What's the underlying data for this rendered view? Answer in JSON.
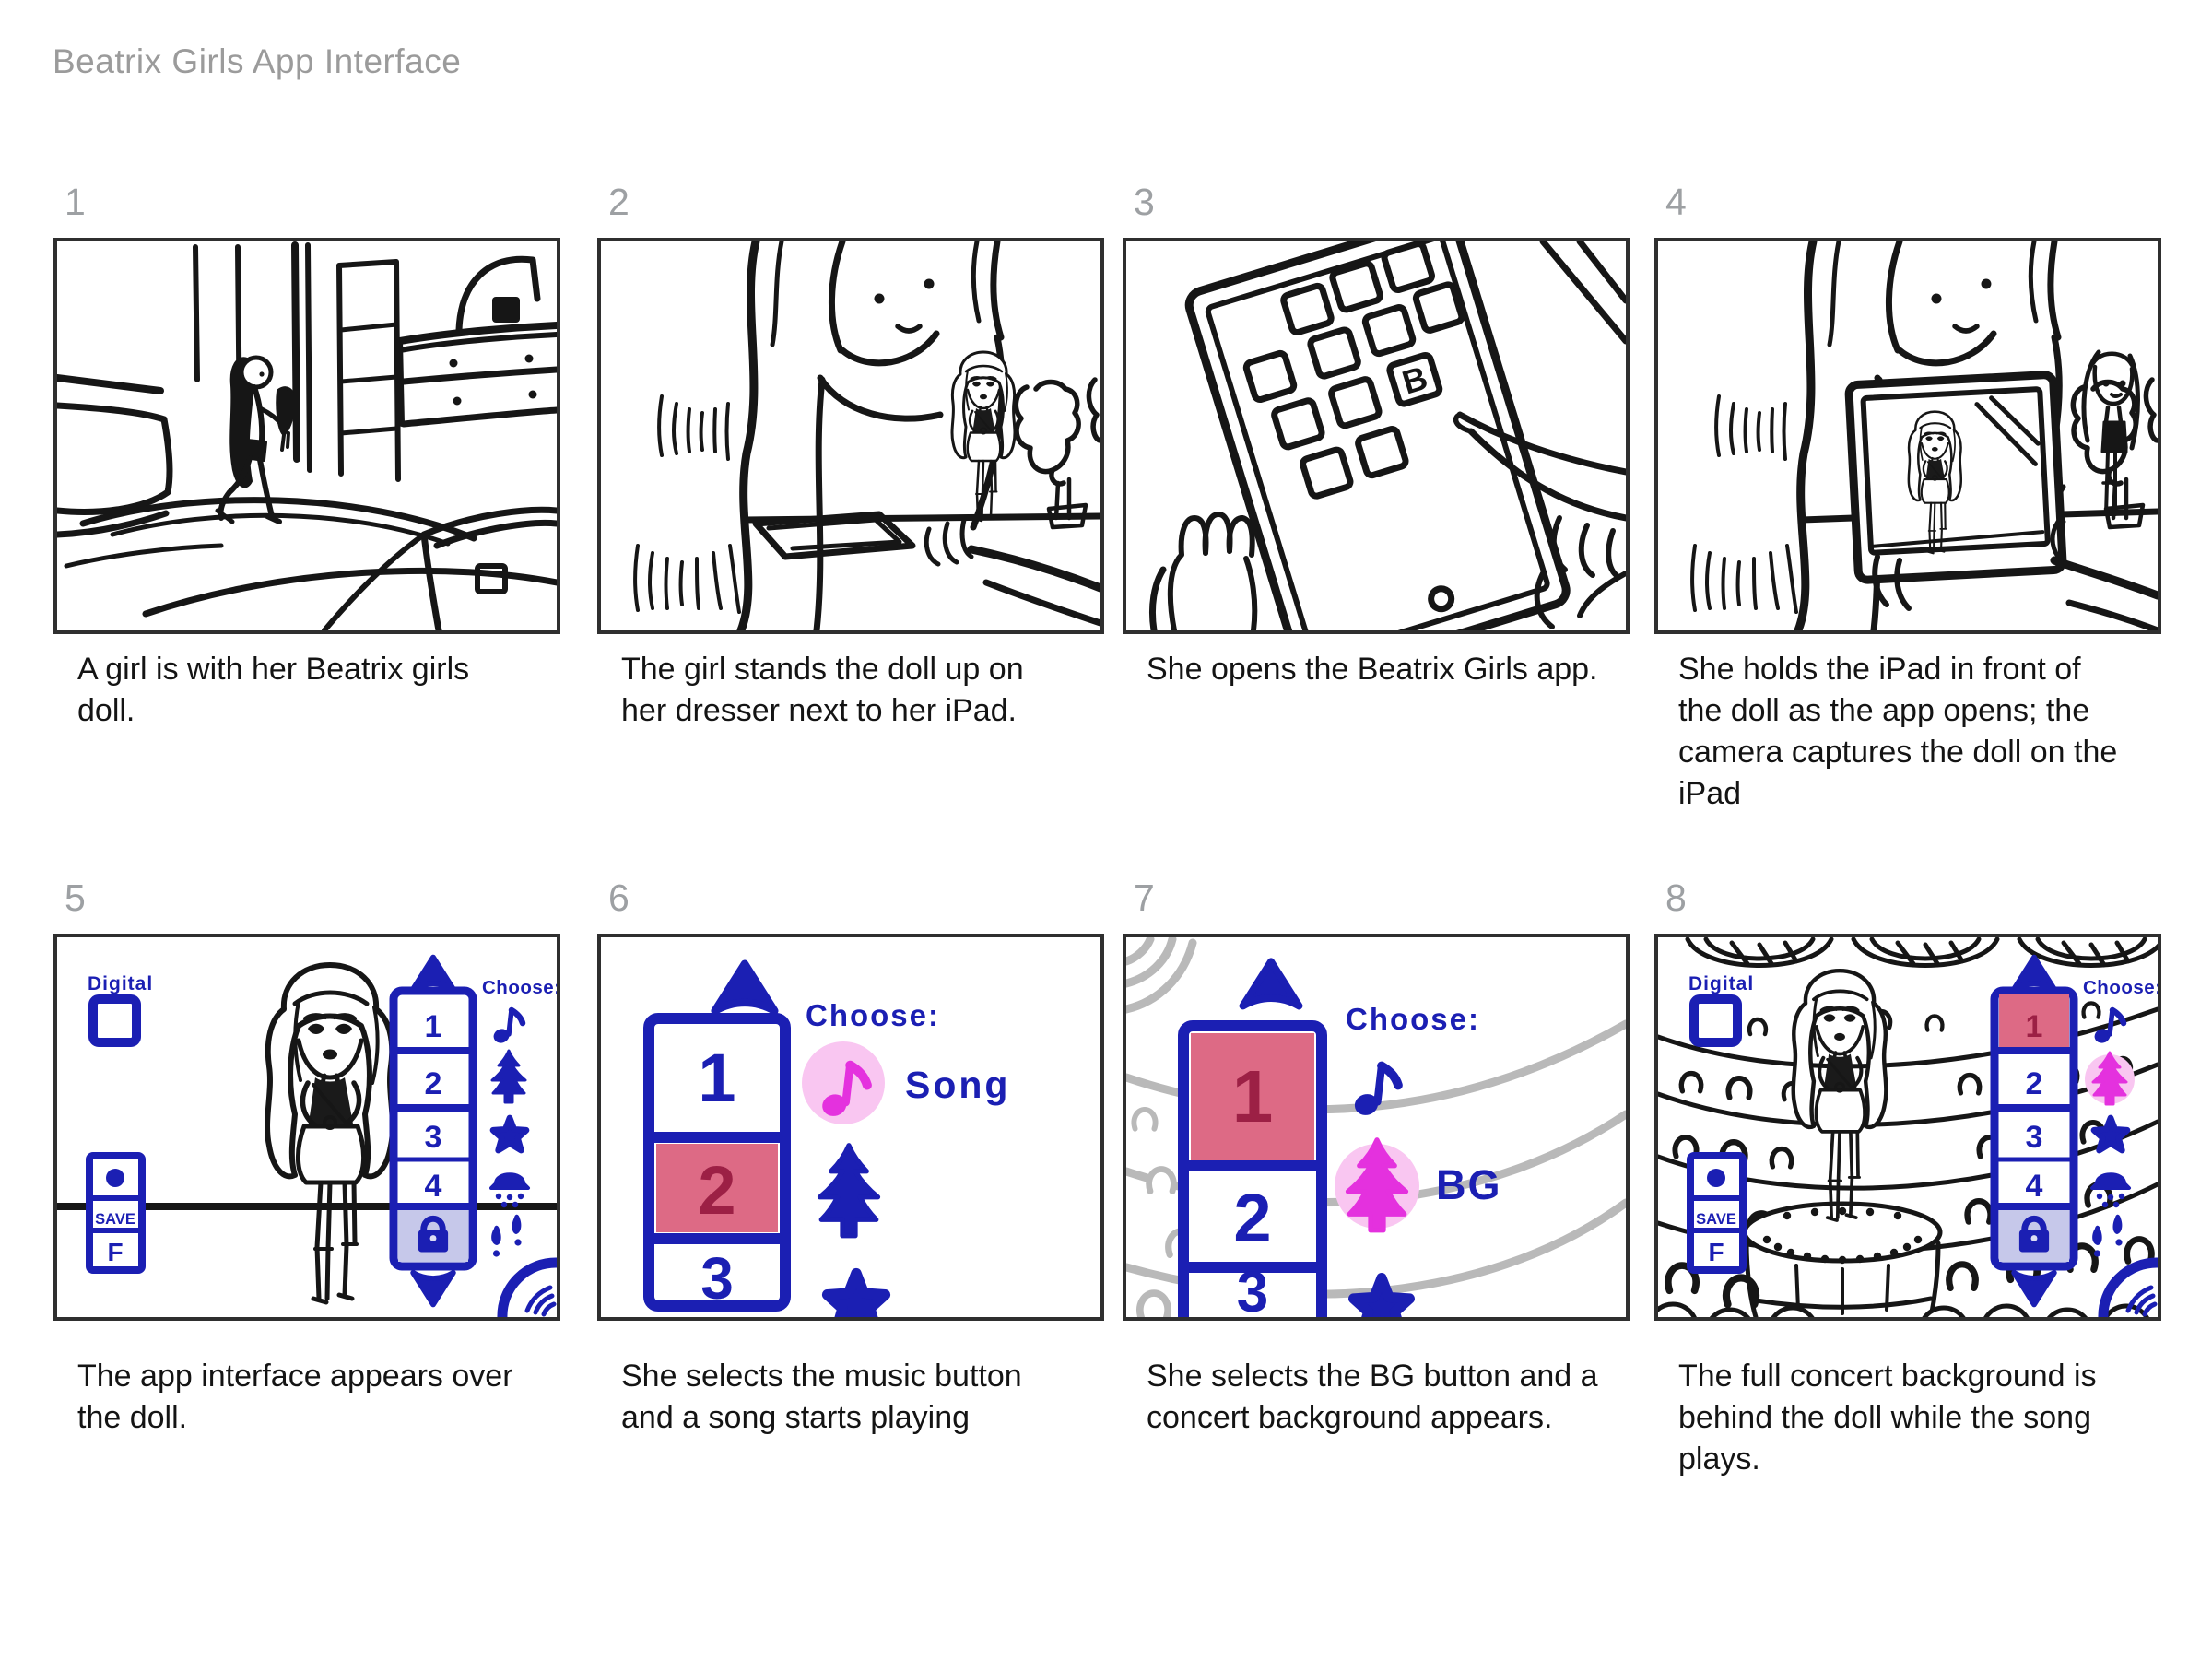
{
  "title": "Beatrix Girls App Interface",
  "panels": [
    {
      "number": "1",
      "caption": "A girl is with her Beatrix girls doll."
    },
    {
      "number": "2",
      "caption": "The girl stands the doll up on her dresser next to her iPad."
    },
    {
      "number": "3",
      "caption": "She opens the Beatrix Girls app."
    },
    {
      "number": "4",
      "caption": "She holds the iPad in front of the doll as the app opens; the camera captures the doll on the iPad"
    },
    {
      "number": "5",
      "caption": "The app interface appears over the doll."
    },
    {
      "number": "6",
      "caption": "She selects the music button and a song starts playing"
    },
    {
      "number": "7",
      "caption": "She selects the BG button and a concert background appears."
    },
    {
      "number": "8",
      "caption": "The full concert background is behind the doll while the song plays."
    }
  ],
  "app_ui": {
    "digital_label": "Digital",
    "save_label": "SAVE",
    "f_label": "F",
    "choose_label": "Choose:",
    "song_label": "Song",
    "bg_label": "BG",
    "app_icon_letter": "B",
    "slots": [
      "1",
      "2",
      "3",
      "4"
    ],
    "icons": [
      "up-arrow",
      "music-note",
      "tree",
      "star",
      "shower",
      "footsteps",
      "lock",
      "down-arrow",
      "sound-signal"
    ]
  },
  "colors": {
    "ui_blue": "#1b1fb3",
    "selection_pink": "#dd6a85",
    "selection_number_red": "#9c2045",
    "magenta": "#e431de",
    "glow_pink": "#f9c6f1",
    "lock_lavender": "#c6c8ea",
    "sketch_black": "#161616",
    "sketch_gray": "#b9b9b9",
    "label_gray": "#9e9e9e"
  }
}
